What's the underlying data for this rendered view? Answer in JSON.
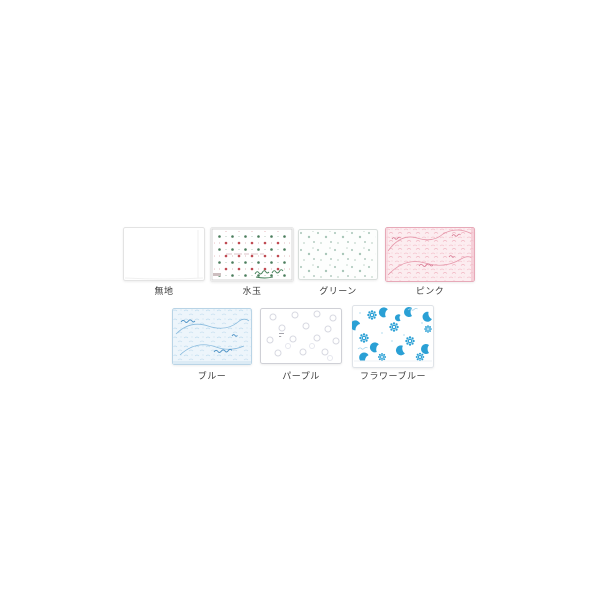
{
  "canvas": {
    "width": 600,
    "height": 600,
    "background": "#ffffff"
  },
  "swatches": [
    {
      "id": "plain",
      "label": "無地",
      "pattern": "plain-white",
      "colors": [
        "#ffffff"
      ]
    },
    {
      "id": "mizutama",
      "label": "水玉",
      "pattern": "polka-dots",
      "colors": [
        "#bf4a52",
        "#4a7d5c"
      ]
    },
    {
      "id": "green",
      "label": "グリーン",
      "pattern": "scattered-dots",
      "colors": [
        "#aec9bc"
      ]
    },
    {
      "id": "pink",
      "label": "ピンク",
      "pattern": "lace-print",
      "colors": [
        "#e698ab"
      ]
    },
    {
      "id": "blue",
      "label": "ブルー",
      "pattern": "lace-print",
      "colors": [
        "#88badd"
      ]
    },
    {
      "id": "purple",
      "label": "パープル",
      "pattern": "rings",
      "colors": [
        "#d7d8e1"
      ]
    },
    {
      "id": "flower-blue",
      "label": "フラワーブルー",
      "pattern": "flowers-and-moons",
      "colors": [
        "#2aa0d5"
      ]
    }
  ]
}
